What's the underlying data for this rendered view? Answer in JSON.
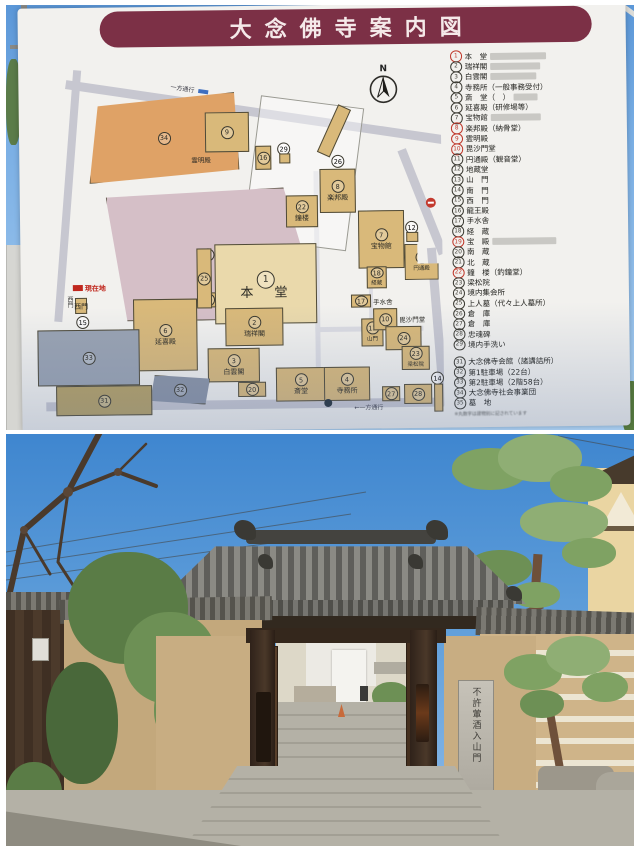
{
  "sign": {
    "title": "大念佛寺案内図",
    "compass_label": "N",
    "you_are_here": "現在地",
    "one_way": "一方通行",
    "one_way_bottom": "←一方通行",
    "legend": {
      "red_numbers": [
        1,
        8,
        9,
        10,
        19,
        22
      ],
      "fine_print": "※丸数字は建物別に記されています",
      "items": [
        {
          "num": 1,
          "label": "本　堂",
          "patch": true
        },
        {
          "num": 2,
          "label": "瑞祥閣",
          "patch": true
        },
        {
          "num": 3,
          "label": "白雲閣",
          "patch": true
        },
        {
          "num": 4,
          "label": "寺務所（一般事務受付）"
        },
        {
          "num": 5,
          "label": "斎　堂（　）",
          "patch": true
        },
        {
          "num": 6,
          "label": "延喜殿（研修場等）"
        },
        {
          "num": 7,
          "label": "宝物館",
          "patch": true
        },
        {
          "num": 8,
          "label": "楽邦殿（納骨堂）"
        },
        {
          "num": 9,
          "label": "霊明殿"
        },
        {
          "num": 10,
          "label": "毘沙門堂"
        },
        {
          "num": 11,
          "label": "円通殿（観音堂）"
        },
        {
          "num": 12,
          "label": "地蔵堂"
        },
        {
          "num": 13,
          "label": "山　門"
        },
        {
          "num": 14,
          "label": "南　門"
        },
        {
          "num": 15,
          "label": "西　門"
        },
        {
          "num": 16,
          "label": "龍王殿"
        },
        {
          "num": 17,
          "label": "手水舎"
        },
        {
          "num": 18,
          "label": "経　蔵"
        },
        {
          "num": 19,
          "label": "宝　殿",
          "patch": true
        },
        {
          "num": 20,
          "label": "南　蔵"
        },
        {
          "num": 21,
          "label": "北　蔵"
        },
        {
          "num": 22,
          "label": "鐘　楼（釣鐘堂）"
        },
        {
          "num": 23,
          "label": "梁松院"
        },
        {
          "num": 24,
          "label": "境内集会所"
        },
        {
          "num": 25,
          "label": "上人墓（代々上人墓所）"
        },
        {
          "num": 26,
          "label": "倉　庫"
        },
        {
          "num": 27,
          "label": "倉　庫"
        },
        {
          "num": 28,
          "label": "忠魂碑"
        },
        {
          "num": 29,
          "label": "境内手洗い"
        },
        {
          "num": 31,
          "label": "大念佛寺会館（諸講詰所）",
          "gap": true
        },
        {
          "num": 32,
          "label": "第1駐車場（22台）"
        },
        {
          "num": 33,
          "label": "第2駐車場（2階58台）"
        },
        {
          "num": 34,
          "label": "大念佛寺社会事業団"
        },
        {
          "num": 35,
          "label": "墓　地"
        }
      ]
    }
  },
  "map": {
    "buildings": [
      {
        "id": "b34",
        "num": 34,
        "label": ""
      },
      {
        "id": "b35",
        "num": 35,
        "label": ""
      },
      {
        "id": "b9",
        "num": 9,
        "label": "霊明殿"
      },
      {
        "id": "b16",
        "num": 16,
        "label": ""
      },
      {
        "id": "b29",
        "num": 29,
        "label": ""
      },
      {
        "id": "b26",
        "num": 26,
        "label": ""
      },
      {
        "id": "b22",
        "num": 22,
        "label": "鐘楼"
      },
      {
        "id": "b8",
        "num": 8,
        "label": "楽邦殿"
      },
      {
        "id": "b7",
        "num": 7,
        "label": "宝物館"
      },
      {
        "id": "b18",
        "num": 18,
        "label": "経蔵"
      },
      {
        "id": "b12",
        "num": 12,
        "label": ""
      },
      {
        "id": "b11",
        "num": 11,
        "label": "円通殿"
      },
      {
        "id": "b1",
        "num": 1,
        "label": "本　堂"
      },
      {
        "id": "b19",
        "num": 19,
        "label": ""
      },
      {
        "id": "b25",
        "num": 25,
        "label": ""
      },
      {
        "id": "b2",
        "num": 2,
        "label": "瑞祥閣"
      },
      {
        "id": "b3",
        "num": 3,
        "label": "白雲閣"
      },
      {
        "id": "b5",
        "num": 5,
        "label": "斎堂"
      },
      {
        "id": "b4",
        "num": 4,
        "label": "寺務所"
      },
      {
        "id": "b20",
        "num": 20,
        "label": ""
      },
      {
        "id": "b6",
        "num": 6,
        "label": "延喜殿"
      },
      {
        "id": "b32",
        "num": 32,
        "label": ""
      },
      {
        "id": "b33",
        "num": 33,
        "label": ""
      },
      {
        "id": "b31",
        "num": 31,
        "label": ""
      },
      {
        "id": "b13",
        "num": 13,
        "label": "山門"
      },
      {
        "id": "b17",
        "num": 17,
        "label": "手水舎"
      },
      {
        "id": "b10",
        "num": 10,
        "label": "毘沙門堂"
      },
      {
        "id": "b24",
        "num": 24,
        "label": ""
      },
      {
        "id": "b23",
        "num": 23,
        "label": "梁松院"
      },
      {
        "id": "b27",
        "num": 27,
        "label": ""
      },
      {
        "id": "b28",
        "num": 28,
        "label": ""
      },
      {
        "id": "b14",
        "num": 14,
        "label": "南門"
      },
      {
        "id": "b15",
        "num": 15,
        "label": "西門"
      }
    ]
  },
  "photo": {
    "pillar_text": "不許葷酒入山門"
  },
  "colors": {
    "banner": "#7c3046",
    "board": "#f2f1ee",
    "building_tan": "#d9b97a",
    "building_pale": "#ead9ab",
    "building_orange": "#dfa266",
    "building_mauve": "#d5bfc7",
    "parking_gray": "#9aa3b2",
    "road_gray": "#c7c7d0",
    "legend_red": "#bf372a",
    "sky_blue": "#4a8fd4"
  }
}
